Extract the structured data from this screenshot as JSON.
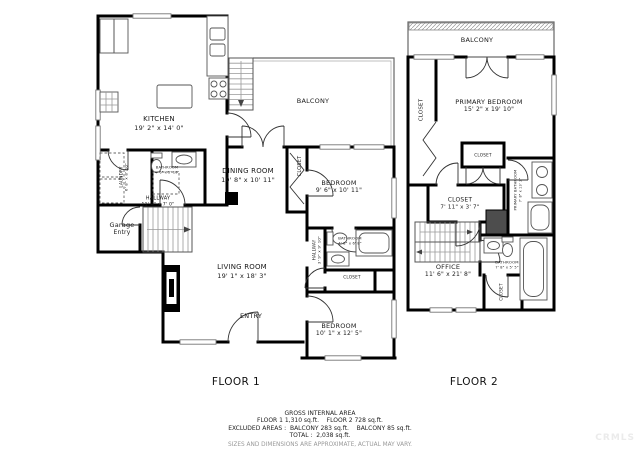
{
  "colors": {
    "wall": "#000000",
    "label_text": "#1a1a1a",
    "footer_text": "#222222",
    "disclaimer_text": "#999999",
    "watermark": "#ebebeb"
  },
  "watermark": "CRMLS",
  "floors": [
    {
      "id": "floor1",
      "title": "FLOOR 1",
      "title_pos": {
        "x": 236,
        "y": 382
      },
      "labels": [
        {
          "name": "balcony",
          "text": "BALCONY",
          "x": 313,
          "y": 101,
          "size": 6.5
        },
        {
          "name": "kitchen",
          "text": "KITCHEN",
          "sub": "19' 2\" x 14' 0\"",
          "x": 159,
          "y": 124,
          "size": 7
        },
        {
          "name": "laundry",
          "text": "LAUNDRY",
          "sub": "6' 8\" x 8' 10\"",
          "x": 124,
          "y": 177,
          "size": 4.2,
          "rot": -90
        },
        {
          "name": "bathroom-1",
          "text": "BATHROOM",
          "sub": "4' 6\" x 5' 10\"",
          "x": 167,
          "y": 170,
          "size": 3.6
        },
        {
          "name": "hallway-1",
          "text": "HALLWAY",
          "sub": "11' 4\" x 7' 0\"",
          "x": 158,
          "y": 202,
          "size": 5
        },
        {
          "name": "garage-entry",
          "text": "Garage",
          "sub": "Entry",
          "x": 122,
          "y": 229,
          "size": 6.5
        },
        {
          "name": "dining-room",
          "text": "DINING ROOM",
          "sub": "19' 8\" x 10' 11\"",
          "x": 248,
          "y": 176,
          "size": 7
        },
        {
          "name": "closet-1",
          "text": "CLOSET",
          "x": 300,
          "y": 166,
          "size": 5,
          "rot": -90
        },
        {
          "name": "bedroom-1",
          "text": "BEDROOM",
          "sub": "9' 6\" x 10' 11\"",
          "x": 339,
          "y": 187,
          "size": 6.5
        },
        {
          "name": "living-room",
          "text": "LIVING ROOM",
          "sub": "19' 1\" x 18' 3\"",
          "x": 242,
          "y": 272,
          "size": 7
        },
        {
          "name": "hallway-2",
          "text": "HALLWAY",
          "sub": "3' 9\" x 9' 10\"",
          "x": 317,
          "y": 250,
          "size": 4.2,
          "rot": -90
        },
        {
          "name": "bathroom-2",
          "text": "BATHROOM",
          "sub": "4' 8\" x 6' 8\"",
          "x": 350,
          "y": 241,
          "size": 3.8
        },
        {
          "name": "closet-2",
          "text": "CLOSET",
          "x": 352,
          "y": 277,
          "size": 4.2
        },
        {
          "name": "entry",
          "text": "ENTRY",
          "x": 251,
          "y": 316,
          "size": 6.5
        },
        {
          "name": "bedroom-2",
          "text": "BEDROOM",
          "sub": "10' 1\" x 12' 5\"",
          "x": 339,
          "y": 330,
          "size": 6.5
        }
      ]
    },
    {
      "id": "floor2",
      "title": "FLOOR 2",
      "title_pos": {
        "x": 474,
        "y": 382
      },
      "labels": [
        {
          "name": "balcony",
          "text": "BALCONY",
          "x": 477,
          "y": 40,
          "size": 6.5
        },
        {
          "name": "closet-left",
          "text": "CLOSET",
          "x": 422,
          "y": 110,
          "size": 5.5,
          "rot": -90
        },
        {
          "name": "primary-bedroom",
          "text": "PRIMARY BEDROOM",
          "sub": "15' 2\" x 19' 10\"",
          "x": 489,
          "y": 106,
          "size": 6.5
        },
        {
          "name": "closet-box",
          "text": "CLOSET",
          "x": 483,
          "y": 155,
          "size": 4.2
        },
        {
          "name": "closet-mid",
          "text": "CLOSET",
          "sub": "7' 11\" x 3' 7\"",
          "x": 460,
          "y": 204,
          "size": 6
        },
        {
          "name": "primary-bathroom",
          "text": "PRIMARY BATHROOM",
          "sub": "7' 8\" x 13' 2\"",
          "x": 518,
          "y": 190,
          "size": 3.6,
          "rot": -90
        },
        {
          "name": "office",
          "text": "OFFICE",
          "sub": "11' 6\" x 21' 8\"",
          "x": 448,
          "y": 271,
          "size": 6.5
        },
        {
          "name": "bathroom",
          "text": "BATHROOM",
          "sub": "7' 8\" x 5' 5\"",
          "x": 507,
          "y": 265,
          "size": 3.8
        },
        {
          "name": "closet-bottom",
          "text": "CLOSET",
          "x": 501,
          "y": 292,
          "size": 4.2,
          "rot": -90
        }
      ]
    }
  ],
  "footer": {
    "title": "GROSS INTERNAL AREA",
    "line1": "FLOOR 1 1,310 sq.ft.    FLOOR 2 728 sq.ft.",
    "line2": "EXCLUDED AREAS :  BALCONY 283 sq.ft.    BALCONY 85 sq.ft.",
    "line3": "TOTAL :  2,038 sq.ft.",
    "disclaimer": "SIZES AND DIMENSIONS ARE APPROXIMATE, ACTUAL MAY VARY."
  }
}
